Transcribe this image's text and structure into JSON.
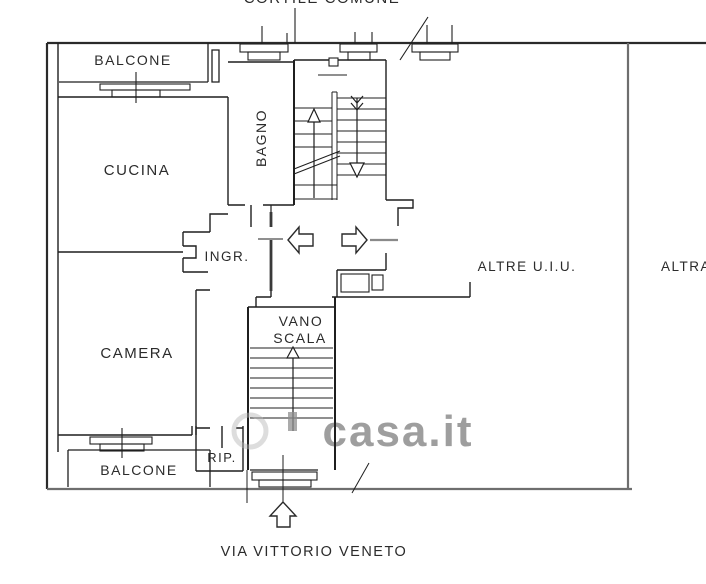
{
  "plan": {
    "top_area_label": "CORTILE COMUNE",
    "street_label": "VIA VITTORIO VENETO",
    "rooms": {
      "balcone_top": "BALCONE",
      "cucina": "CUCINA",
      "bagno": "BAGNO",
      "ingresso": "INGR.",
      "camera": "CAMERA",
      "vano_scala_line1": "VANO",
      "vano_scala_line2": "SCALA",
      "ripostiglio": "RIP.",
      "balcone_bottom": "BALCONE",
      "other_units": "ALTRE U.I.U.",
      "other_unit_right": "ALTRA"
    },
    "watermark_text": "casa.it",
    "colors": {
      "wall": "#2a2a2a",
      "boundary_gray": "#6e6e6e",
      "door_gray": "#8a8a8a",
      "text": "#2b2b2b",
      "watermark": "#b4b4b4",
      "background": "#ffffff"
    }
  }
}
